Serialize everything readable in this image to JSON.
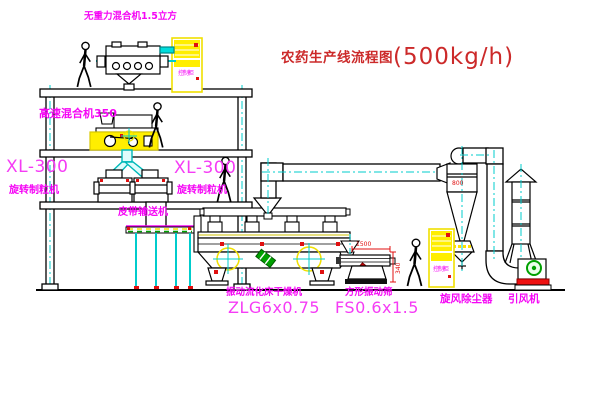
{
  "title": {
    "text": "农药生产线流程图",
    "capacity": "(500kg/h)"
  },
  "labels": {
    "gravity_mixer": "无重力混合机1.5立方",
    "high_speed_mixer": "高速混合机350",
    "granulator_left": {
      "model": "XL-300",
      "name": "旋转制粒机"
    },
    "granulator_right": {
      "model": "XL-300",
      "name": "旋转制粒机"
    },
    "belt_conveyor": "皮带输送机",
    "dryer": {
      "name": "振动流化床干燥机",
      "model": "ZLG6x0.75"
    },
    "sieve": {
      "name": "方形振动筛",
      "model": "FS0.6x1.5"
    },
    "cyclone": "旋风除尘器",
    "fan": "引风机",
    "control_cabinet": "控制柜"
  },
  "dimensions": {
    "sieve_length": "1500",
    "sieve_height": "340",
    "cyclone_size": "800"
  },
  "colors": {
    "label_magenta": "#f505f5",
    "title_red": "#cc2a2a",
    "line_black": "#000000",
    "centerline_cyan": "#00cccc",
    "highlight_yellow": "#ffee00",
    "accent_red": "#ee1111",
    "machine_green": "#00a000"
  }
}
